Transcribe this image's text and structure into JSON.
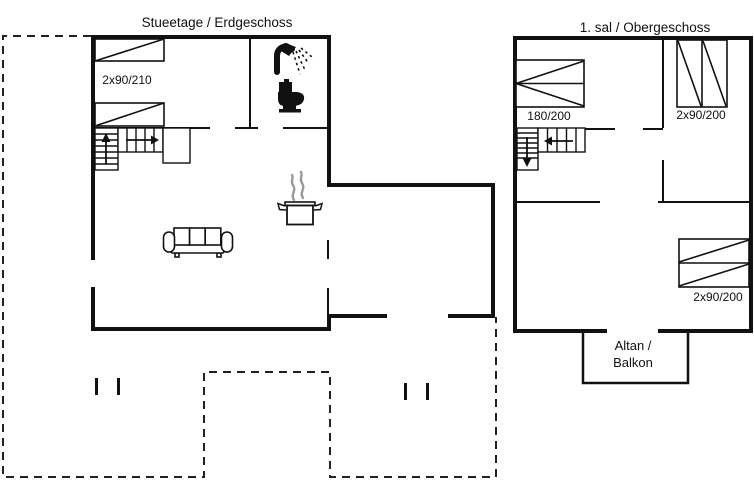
{
  "canvas": {
    "width": 754,
    "height": 498,
    "background": "#ffffff",
    "line_color": "#111111",
    "steam_color": "#999999"
  },
  "ground_floor": {
    "title": "Stueetage / Erdgeschoss",
    "bed_label": "2x90/210"
  },
  "upper_floor": {
    "title": "1. sal / Obergeschoss",
    "double_bed_label": "180/200",
    "bunk_bed_label": "2x90/200",
    "right_bed_label": "2x90/200",
    "balcony_label_line1": "Altan /",
    "balcony_label_line2": "Balkon"
  },
  "icons": {
    "shower": "shower-icon",
    "toilet": "toilet-icon",
    "cooking_pot": "cooking-pot-icon",
    "sofa": "sofa-icon",
    "stairs_up": "arrow-up-icon",
    "stairs_right": "arrow-right-icon",
    "stairs_down": "arrow-down-icon",
    "stairs_left": "arrow-left-icon"
  }
}
